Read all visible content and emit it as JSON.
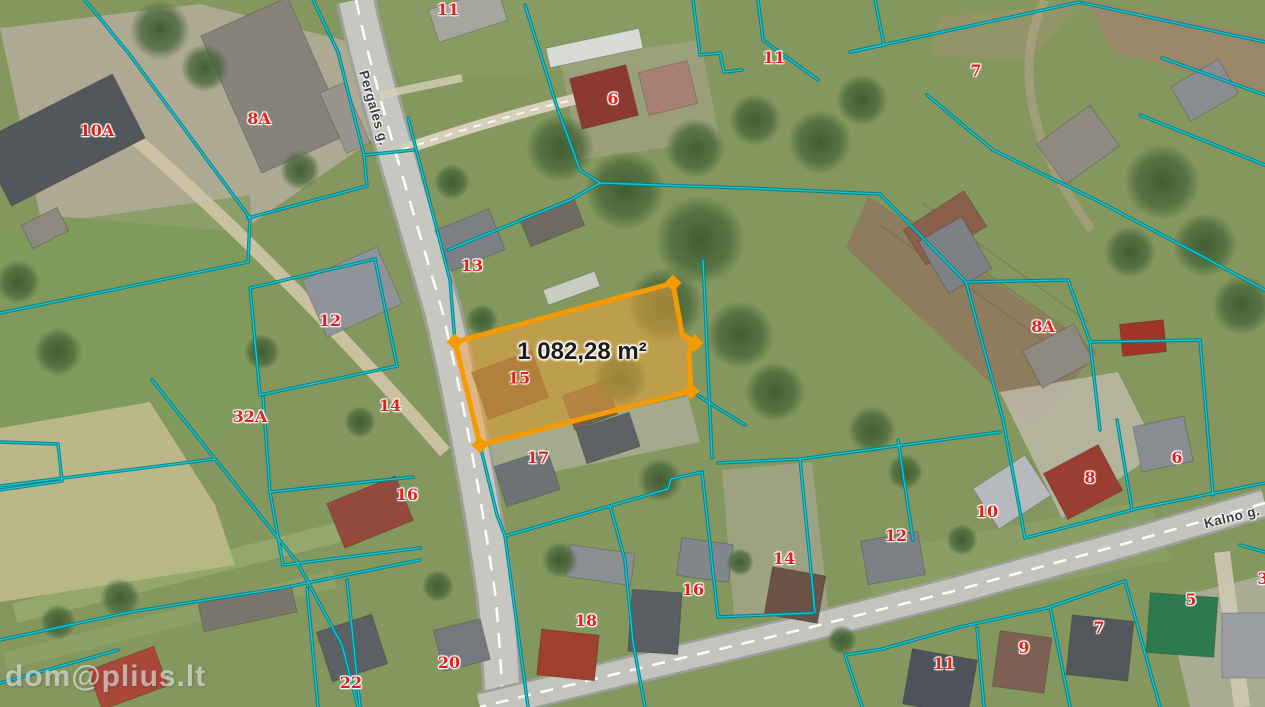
{
  "map": {
    "view": "aerial-cadastral",
    "watermark": "dom@plius.lt",
    "highlighted_parcel": {
      "number": "15",
      "area_label": "1 082,28 m²"
    },
    "street_labels": [
      {
        "text": "Pergalės g.",
        "x": 374,
        "y": 108,
        "rotation": 74
      },
      {
        "text": "Kalno g.",
        "x": 1232,
        "y": 517,
        "rotation": -14
      }
    ],
    "parcel_labels": [
      {
        "text": "10A",
        "x": 97,
        "y": 131
      },
      {
        "text": "8A",
        "x": 259,
        "y": 119
      },
      {
        "text": "11",
        "x": 448,
        "y": 10
      },
      {
        "text": "6",
        "x": 613,
        "y": 99
      },
      {
        "text": "11",
        "x": 774,
        "y": 58
      },
      {
        "text": "7",
        "x": 976,
        "y": 71
      },
      {
        "text": "13",
        "x": 472,
        "y": 266
      },
      {
        "text": "12",
        "x": 330,
        "y": 321
      },
      {
        "text": "32A",
        "x": 250,
        "y": 417
      },
      {
        "text": "14",
        "x": 390,
        "y": 406
      },
      {
        "text": "16",
        "x": 407,
        "y": 495
      },
      {
        "text": "17",
        "x": 538,
        "y": 458
      },
      {
        "text": "18",
        "x": 586,
        "y": 621
      },
      {
        "text": "16",
        "x": 693,
        "y": 590
      },
      {
        "text": "14",
        "x": 784,
        "y": 559
      },
      {
        "text": "22",
        "x": 351,
        "y": 683
      },
      {
        "text": "20",
        "x": 449,
        "y": 663
      },
      {
        "text": "12",
        "x": 896,
        "y": 536
      },
      {
        "text": "10",
        "x": 987,
        "y": 512
      },
      {
        "text": "8",
        "x": 1090,
        "y": 478
      },
      {
        "text": "6",
        "x": 1177,
        "y": 458
      },
      {
        "text": "8A",
        "x": 1043,
        "y": 327
      },
      {
        "text": "11",
        "x": 944,
        "y": 664
      },
      {
        "text": "9",
        "x": 1024,
        "y": 648
      },
      {
        "text": "7",
        "x": 1099,
        "y": 628
      },
      {
        "text": "5",
        "x": 1191,
        "y": 600
      },
      {
        "text": "3",
        "x": 1263,
        "y": 579
      }
    ],
    "colors": {
      "parcel_boundary": "#18cfd8",
      "parcel_boundary_dark": "#00818c",
      "parcel_number": "#e0201c",
      "street_label": "#3c3c3c",
      "highlight_stroke": "#f59a00",
      "highlight_fill": "rgba(246,166,58,0.5)",
      "area_label_text": "#1d1d1d"
    }
  }
}
